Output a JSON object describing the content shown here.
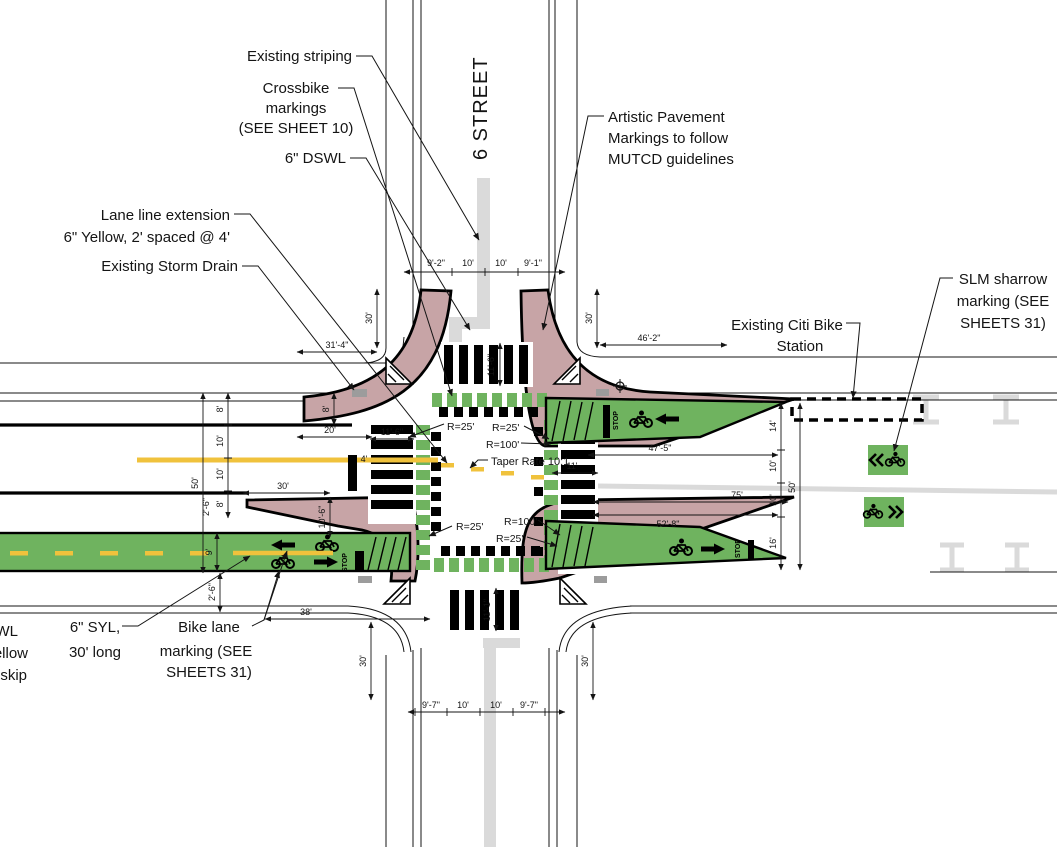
{
  "drawing": {
    "street_label": "6 STREET",
    "callouts": {
      "existing_striping": "Existing striping",
      "crossbike": [
        "Crossbike",
        "markings",
        "(SEE SHEET 10)"
      ],
      "dswl": "6\" DSWL",
      "artistic": [
        "Artistic Pavement",
        "Markings to follow",
        "MUTCD guidelines"
      ],
      "lane_line_extension": [
        "Lane line extension",
        "6\" Yellow, 2' spaced @ 4'"
      ],
      "storm_drain": "Existing Storm Drain",
      "citi_bike": [
        "Existing Citi Bike",
        "Station"
      ],
      "slm_sharrow": [
        "SLM sharrow",
        "marking (SEE",
        "SHEETS 31)"
      ],
      "syl": [
        "6\" SYL,",
        "30' long"
      ],
      "bike_lane_marking": [
        "Bike lane",
        "marking (SEE",
        "SHEETS 31)"
      ],
      "taper_rate": "Taper Rate 10:1",
      "edge_cutoff": [
        "WL",
        "ellow",
        "skip"
      ]
    },
    "radius_labels": {
      "r25": "R=25'",
      "r100": "R=100'"
    },
    "dims": {
      "north_chain": [
        "9'-2\"",
        "10'",
        "10'",
        "9'-1\""
      ],
      "south_chain": [
        "9'-7\"",
        "10'",
        "10'",
        "9'-7\""
      ],
      "west_chain": [
        "8'",
        "10'",
        "10'",
        "8'"
      ],
      "east_chain": [
        "14'",
        "10'",
        "10'",
        "16'"
      ],
      "w50": "50'",
      "w30": "30'",
      "w20": "20'",
      "w4": "4'",
      "w2_6": "2'-6\"",
      "w9": "9'",
      "w8": "8'",
      "w10_6": "10'-6\"",
      "w11_6": "11'-6\"",
      "n30": "30'",
      "n31_4": "31'-4\"",
      "e46_2": "46'-2\"",
      "cw_n": "11'-6\"",
      "cw_s": "11'-1\"",
      "cw_e": "11'",
      "e47_5": "47'-5\"",
      "e75": "75'",
      "e52_8": "52'-8\"",
      "e50": "50'",
      "s38": "38'",
      "s30": "30'"
    },
    "pavement": {
      "stop": "STOP"
    },
    "colors": {
      "bike_green": "#6fb35f",
      "curb_ext_pink": "#c7a4a6",
      "center_yellow": "#f0c23c",
      "existing_gray": "#dadada"
    }
  }
}
